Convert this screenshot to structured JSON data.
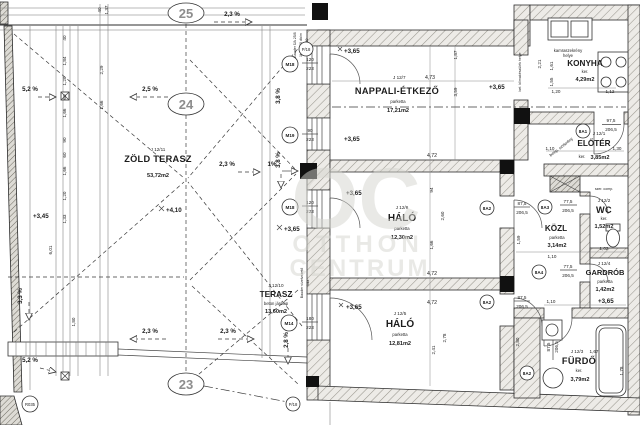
{
  "axis": {
    "a25": "25",
    "a24": "24",
    "a23": "23"
  },
  "rooms": {
    "nappali": {
      "code": "J 12/7",
      "name": "NAPPALI-ÉTKEZŐ",
      "floor": "parketta",
      "area": "17,21m2"
    },
    "konyha": {
      "name": "KONYHA",
      "floor": "ker.",
      "area": "4,29m2"
    },
    "eloter": {
      "code": "J 12/1",
      "name": "ELŐTÉR",
      "floor": "ker.",
      "area": "3,85m2"
    },
    "wc": {
      "code": "J 12/2",
      "name": "WC",
      "floor": "ker.",
      "area": "1,52m2"
    },
    "kozl": {
      "name": "KÖZL",
      "floor": "parketta",
      "area": "3,14m2"
    },
    "gardrob": {
      "code": "J 12/4",
      "name": "GARDRÓB",
      "floor": "parketta",
      "area": "1,42m2"
    },
    "furdo": {
      "code": "J 12/3",
      "name": "FÜRDŐ",
      "floor": "ker.",
      "area": "3,79m2"
    },
    "halo1": {
      "code": "J 12/6",
      "name": "HÁLÓ",
      "floor": "parketta",
      "area": "12,30m2"
    },
    "halo2": {
      "code": "J 12/5",
      "name": "HÁLÓ",
      "floor": "parketta",
      "area": "12,81m2"
    },
    "terasz": {
      "code": "J 12/10",
      "name": "TERASZ",
      "floor": "beton járólap",
      "area": "13,60m2"
    },
    "zold": {
      "code": "J 12/11",
      "name": "ZÖLD TERASZ",
      "area": "53,72m2"
    }
  },
  "windows": {
    "m18": "M18",
    "m19": "M19",
    "m14": "M14",
    "w120": "120",
    "w90": "90",
    "w180": "180",
    "h223": "223"
  },
  "doors": {
    "c1": "8A1",
    "c2": "8A2",
    "c3": "8A3",
    "c4": "8A4",
    "w975": "97,5",
    "w875": "87,5",
    "w775": "77,5",
    "h2065": "206,5"
  },
  "slopes": {
    "p23": "2,3 %",
    "p25": "2,5 %",
    "p52": "5,2 %",
    "p33": "3,3 %",
    "p28": "2,8 %",
    "p38": "3,8 %",
    "p1": "1%"
  },
  "levels": {
    "l365": "+3,65",
    "l410": "+4,10",
    "l345": "+3,45"
  },
  "dims": {
    "d40": "40",
    "d137": "1,37",
    "d184": "1,84",
    "d120": "1,20",
    "d229": "2,29",
    "d60": "60",
    "d166": "1,66",
    "d90": "90",
    "d133": "1,33",
    "d601": "6,01",
    "d180": "1,80",
    "d473": "4,73",
    "d359": "3,59",
    "d187": "1,87",
    "d472": "4,72",
    "d260": "2,60",
    "d94": "94",
    "d241": "2,41",
    "d278": "2,78",
    "d280": "2,80",
    "d221": "2,21",
    "d161": "1,61",
    "d155": "1,55",
    "d112": "1,12",
    "d110": "1,10",
    "d130": "1,30",
    "d102": "1,02",
    "d159": "1,59",
    "d167": "1,67",
    "d178": "1,78"
  },
  "notes": {
    "bauder1": "Bauder ÜA 25/8",
    "bauder2": "1t útb. 40 db/m",
    "bauder3": "250/250",
    "bauder4": "Bauder vízelvezető",
    "bauder5": "fólia",
    "klima": "bel. klímakészülék helye",
    "kamra1": "kamraszekrény",
    "kamra2": "helye",
    "szekreny": "beép. szekrény",
    "szercomp": "szer. comp."
  },
  "markers": {
    "p18": "P/18",
    "r035": "R035"
  },
  "watermark": {
    "logo": "OC",
    "line1": "OTTHON",
    "line2": "CENTRUM"
  }
}
